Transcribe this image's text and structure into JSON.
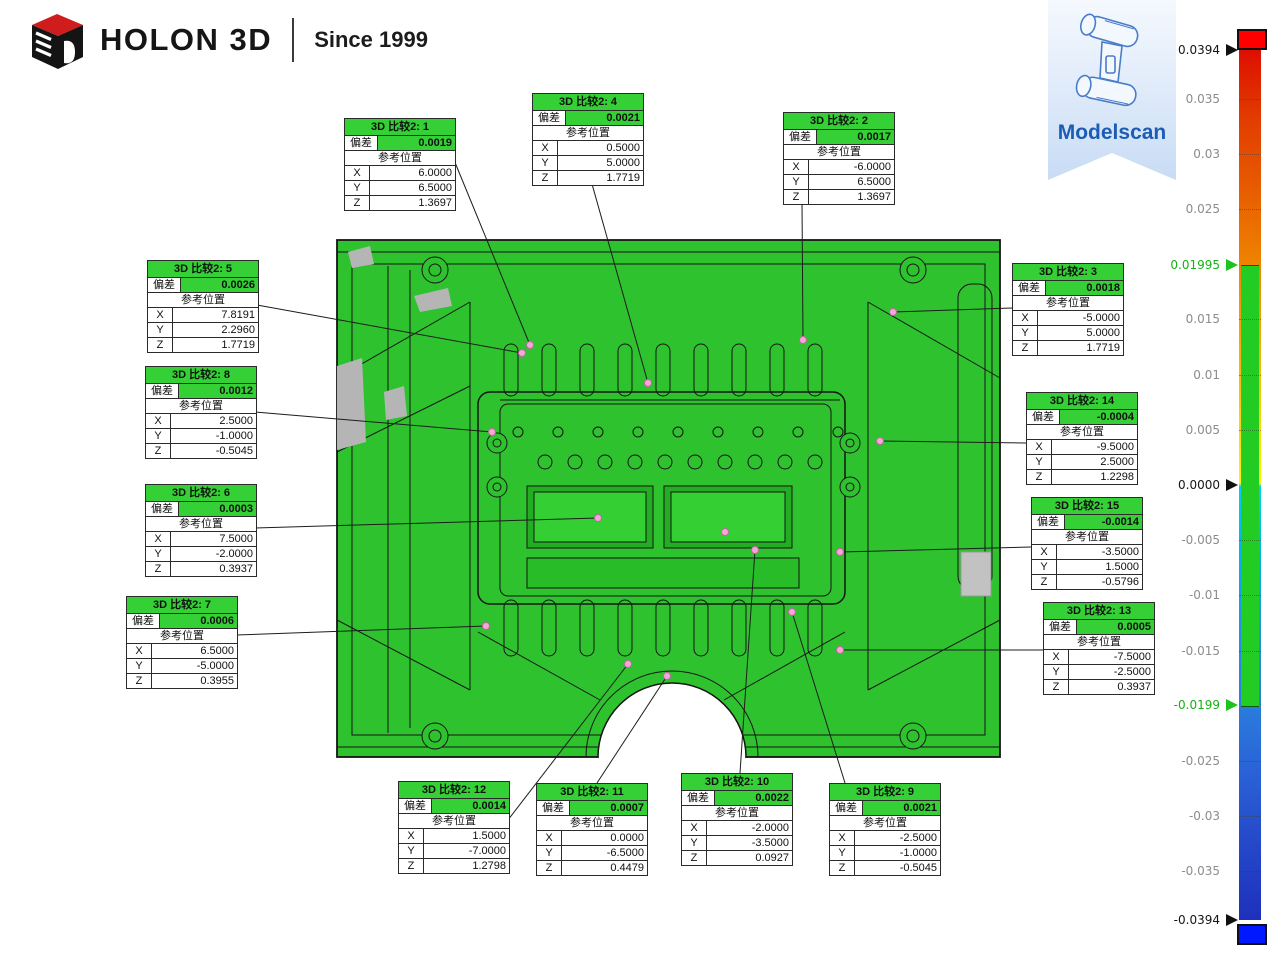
{
  "header": {
    "brand": "HOLON 3D",
    "since": "Since 1999"
  },
  "badge": {
    "label": "Modelscan"
  },
  "strings": {
    "dev": "偏差",
    "ref": "参考位置",
    "x": "X",
    "y": "Y",
    "z": "Z"
  },
  "annotations": [
    {
      "id": 1,
      "title": "3D 比较2: 1",
      "dev": "0.0019",
      "x": "6.0000",
      "y": "6.5000",
      "z": "1.3697"
    },
    {
      "id": 2,
      "title": "3D 比较2: 2",
      "dev": "0.0017",
      "x": "-6.0000",
      "y": "6.5000",
      "z": "1.3697"
    },
    {
      "id": 3,
      "title": "3D 比较2: 3",
      "dev": "0.0018",
      "x": "-5.0000",
      "y": "5.0000",
      "z": "1.7719"
    },
    {
      "id": 4,
      "title": "3D 比较2: 4",
      "dev": "0.0021",
      "x": "0.5000",
      "y": "5.0000",
      "z": "1.7719"
    },
    {
      "id": 5,
      "title": "3D 比较2: 5",
      "dev": "0.0026",
      "x": "7.8191",
      "y": "2.2960",
      "z": "1.7719"
    },
    {
      "id": 6,
      "title": "3D 比较2: 6",
      "dev": "0.0003",
      "x": "7.5000",
      "y": "-2.0000",
      "z": "0.3937"
    },
    {
      "id": 7,
      "title": "3D 比较2: 7",
      "dev": "0.0006",
      "x": "6.5000",
      "y": "-5.0000",
      "z": "0.3955"
    },
    {
      "id": 8,
      "title": "3D 比较2: 8",
      "dev": "0.0012",
      "x": "2.5000",
      "y": "-1.0000",
      "z": "-0.5045"
    },
    {
      "id": 9,
      "title": "3D 比较2: 9",
      "dev": "0.0021",
      "x": "-2.5000",
      "y": "-1.0000",
      "z": "-0.5045"
    },
    {
      "id": 10,
      "title": "3D 比较2: 10",
      "dev": "0.0022",
      "x": "-2.0000",
      "y": "-3.5000",
      "z": "0.0927"
    },
    {
      "id": 11,
      "title": "3D 比较2: 11",
      "dev": "0.0007",
      "x": "0.0000",
      "y": "-6.5000",
      "z": "0.4479"
    },
    {
      "id": 12,
      "title": "3D 比较2: 12",
      "dev": "0.0014",
      "x": "1.5000",
      "y": "-7.0000",
      "z": "1.2798"
    },
    {
      "id": 13,
      "title": "3D 比较2: 13",
      "dev": "0.0005",
      "x": "-7.5000",
      "y": "-2.5000",
      "z": "0.3937"
    },
    {
      "id": 14,
      "title": "3D 比较2: 14",
      "dev": "-0.0004",
      "x": "-9.5000",
      "y": "2.5000",
      "z": "1.2298"
    },
    {
      "id": 15,
      "title": "3D 比较2: 15",
      "dev": "-0.0014",
      "x": "-3.5000",
      "y": "1.5000",
      "z": "-0.5796"
    }
  ],
  "colorbar": {
    "max_label": "0.0394",
    "min_label": "-0.0394",
    "upper_tolerance": "0.01995",
    "lower_tolerance": "-0.0199",
    "colors": {
      "over": "#ff0000",
      "under": "#0018ff",
      "in_tolerance": "#22cc22"
    },
    "ticks": [
      {
        "label": "0.0394",
        "value": 0.0394,
        "style": "black-arrow"
      },
      {
        "label": "0.035",
        "value": 0.035,
        "style": "plain"
      },
      {
        "label": "0.03",
        "value": 0.03,
        "style": "plain"
      },
      {
        "label": "0.025",
        "value": 0.025,
        "style": "plain"
      },
      {
        "label": "0.01995",
        "value": 0.01995,
        "style": "green-arrow"
      },
      {
        "label": "0.015",
        "value": 0.015,
        "style": "plain"
      },
      {
        "label": "0.01",
        "value": 0.01,
        "style": "plain"
      },
      {
        "label": "0.005",
        "value": 0.005,
        "style": "plain"
      },
      {
        "label": "0.0000",
        "value": 0,
        "style": "black-arrow"
      },
      {
        "label": "-0.005",
        "value": -0.005,
        "style": "plain"
      },
      {
        "label": "-0.01",
        "value": -0.01,
        "style": "plain"
      },
      {
        "label": "-0.015",
        "value": -0.015,
        "style": "plain"
      },
      {
        "label": "-0.0199",
        "value": -0.0199,
        "style": "green-arrow"
      },
      {
        "label": "-0.025",
        "value": -0.025,
        "style": "plain"
      },
      {
        "label": "-0.03",
        "value": -0.03,
        "style": "plain"
      },
      {
        "label": "-0.035",
        "value": -0.035,
        "style": "plain"
      },
      {
        "label": "-0.0394",
        "value": -0.0394,
        "style": "black-arrow"
      }
    ]
  }
}
